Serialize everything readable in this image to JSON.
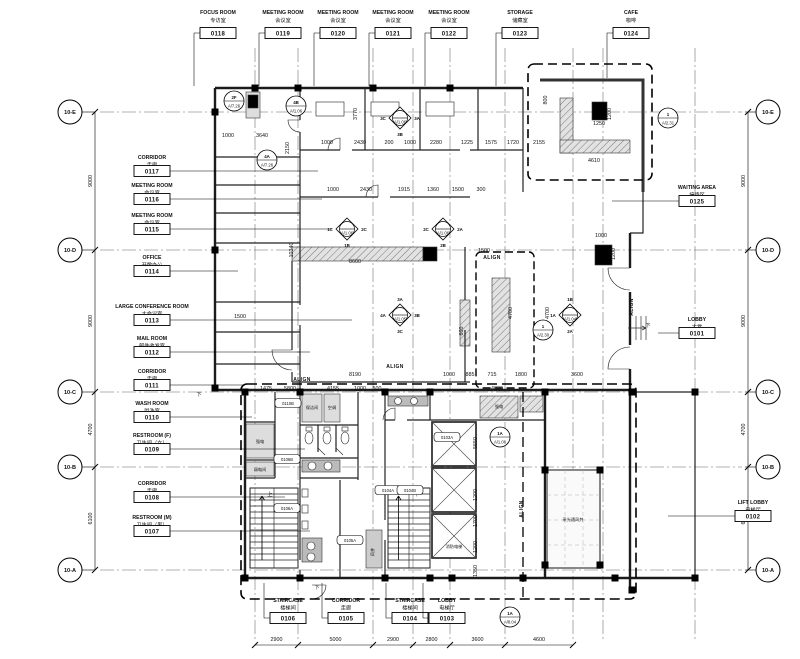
{
  "grid": {
    "row_labels": [
      "10-E",
      "10-D",
      "10-C",
      "10-B",
      "10-A"
    ]
  },
  "dimensions": {
    "left": [
      "9000",
      "9000",
      "4700",
      "6100"
    ],
    "right": [
      "9000",
      "9000",
      "4700",
      "6100"
    ],
    "bottom": [
      "2900",
      "5000",
      "2900",
      "2800",
      "3600",
      "4600"
    ]
  },
  "rooms": {
    "top": [
      {
        "name": "FOCUS ROOM",
        "cn": "专访室",
        "num": "0118"
      },
      {
        "name": "MEETING ROOM",
        "cn": "会议室",
        "num": "0119"
      },
      {
        "name": "MEETING ROOM",
        "cn": "会议室",
        "num": "0120"
      },
      {
        "name": "MEETING ROOM",
        "cn": "会议室",
        "num": "0121"
      },
      {
        "name": "MEETING ROOM",
        "cn": "会议室",
        "num": "0122"
      },
      {
        "name": "STORAGE",
        "cn": "储藏室",
        "num": "0123"
      },
      {
        "name": "CAFE",
        "cn": "咖啡",
        "num": "0124"
      }
    ],
    "left": [
      {
        "name": "CORRIDOR",
        "cn": "走廊",
        "num": "0117"
      },
      {
        "name": "MEETING ROOM",
        "cn": "会议室",
        "num": "0116"
      },
      {
        "name": "MEETING ROOM",
        "cn": "会议室",
        "num": "0115"
      },
      {
        "name": "OFFICE",
        "cn": "开敞办公",
        "num": "0114"
      },
      {
        "name": "LARGE CONFERENCE ROOM",
        "cn": "大会议室",
        "num": "0113"
      },
      {
        "name": "MAIL ROOM",
        "cn": "邮件收发室",
        "num": "0112"
      },
      {
        "name": "CORRIDOR",
        "cn": "走廊",
        "num": "0111"
      },
      {
        "name": "WASH ROOM",
        "cn": "盥洗室",
        "num": "0110"
      },
      {
        "name": "RESTROOM (F)",
        "cn": "卫生间（女）",
        "num": "0109"
      },
      {
        "name": "CORRIDOR",
        "cn": "走廊",
        "num": "0108"
      },
      {
        "name": "RESTROOM (M)",
        "cn": "卫生间（男）",
        "num": "0107"
      }
    ],
    "right": [
      {
        "name": "WAITING AREA",
        "cn": "接待区",
        "num": "0125"
      },
      {
        "name": "LOBBY",
        "cn": "大堂",
        "num": "0101"
      },
      {
        "name": "LIFT LOBBY",
        "cn": "电梯厅",
        "num": "0102"
      }
    ],
    "bottom": [
      {
        "name": "STAIRCASE",
        "cn": "楼梯间",
        "num": "0106"
      },
      {
        "name": "CORRIDOR",
        "cn": "走廊",
        "num": "0105"
      },
      {
        "name": "STAIRCASE",
        "cn": "楼梯间",
        "num": "0104"
      },
      {
        "name": "LOBBY",
        "cn": "电梯厅",
        "num": "0103"
      }
    ]
  },
  "door_tags": [
    "0110B",
    "0106B",
    "0106A",
    "0104A",
    "0104B",
    "0103A",
    "0105A"
  ],
  "core_labels": {
    "elec": "强电",
    "low_volt": "弱电间",
    "clean": "保洁间",
    "ac": "空调",
    "shaft": "风井",
    "fire_lift": "消防电梯",
    "light_well": "采光通风井"
  },
  "annotations": {
    "align": "ALIGN",
    "down": "下",
    "up": "上"
  },
  "markers": [
    {
      "shape": "circle",
      "top": "2F",
      "sheet": "A/7.26"
    },
    {
      "shape": "circle",
      "top": "4B",
      "sheet": "A/1.06"
    },
    {
      "shape": "circle",
      "top": "4A",
      "sheet": "A/7.26"
    },
    {
      "shape": "diamond",
      "sheet": "A/1.06",
      "sides": {
        "l": "3C",
        "r": "3A",
        "b": "3B"
      }
    },
    {
      "shape": "diamond",
      "sheet": "A/1.06",
      "sides": {
        "l": "1C",
        "r": "2C",
        "b": "1B"
      }
    },
    {
      "shape": "diamond",
      "sheet": "A/1.06",
      "sides": {
        "l": "2C",
        "r": "2A",
        "b": "2B"
      }
    },
    {
      "shape": "diamond",
      "sheet": "A/1.05",
      "sides": {
        "t": "3A",
        "l": "4A",
        "r": "3B",
        "b": "3C"
      }
    },
    {
      "shape": "diamond",
      "sheet": "A/1.04",
      "sides": {
        "t": "1B",
        "l": "1A",
        "b": "2A"
      }
    },
    {
      "shape": "circle",
      "top": "1",
      "sheet": "A/2.30"
    },
    {
      "shape": "circle",
      "top": "1",
      "sheet": "A/2.31"
    },
    {
      "shape": "circle",
      "top": "1A",
      "sheet": "A/1.06"
    },
    {
      "shape": "circle",
      "top": "1A",
      "sheet": "A/8.04"
    }
  ],
  "inline_dims": [
    "1000",
    "3640",
    "2150",
    "1000",
    "2430",
    "200",
    "1000",
    "2280",
    "1225",
    "1575",
    "1720",
    "2155",
    "1000",
    "2430",
    "1915",
    "1360",
    "1500",
    "300",
    "3770",
    "10340",
    "8600",
    "1500",
    "1000",
    "1200",
    "4700",
    "4700",
    "600",
    "1500",
    "8190",
    "1000",
    "885",
    "715",
    "1800",
    "3600",
    "1475",
    "5800",
    "4155",
    "1000",
    "500",
    "4820",
    "1250",
    "1200",
    "4610",
    "800",
    "5650",
    "1200",
    "1700",
    "1200",
    "1350"
  ]
}
